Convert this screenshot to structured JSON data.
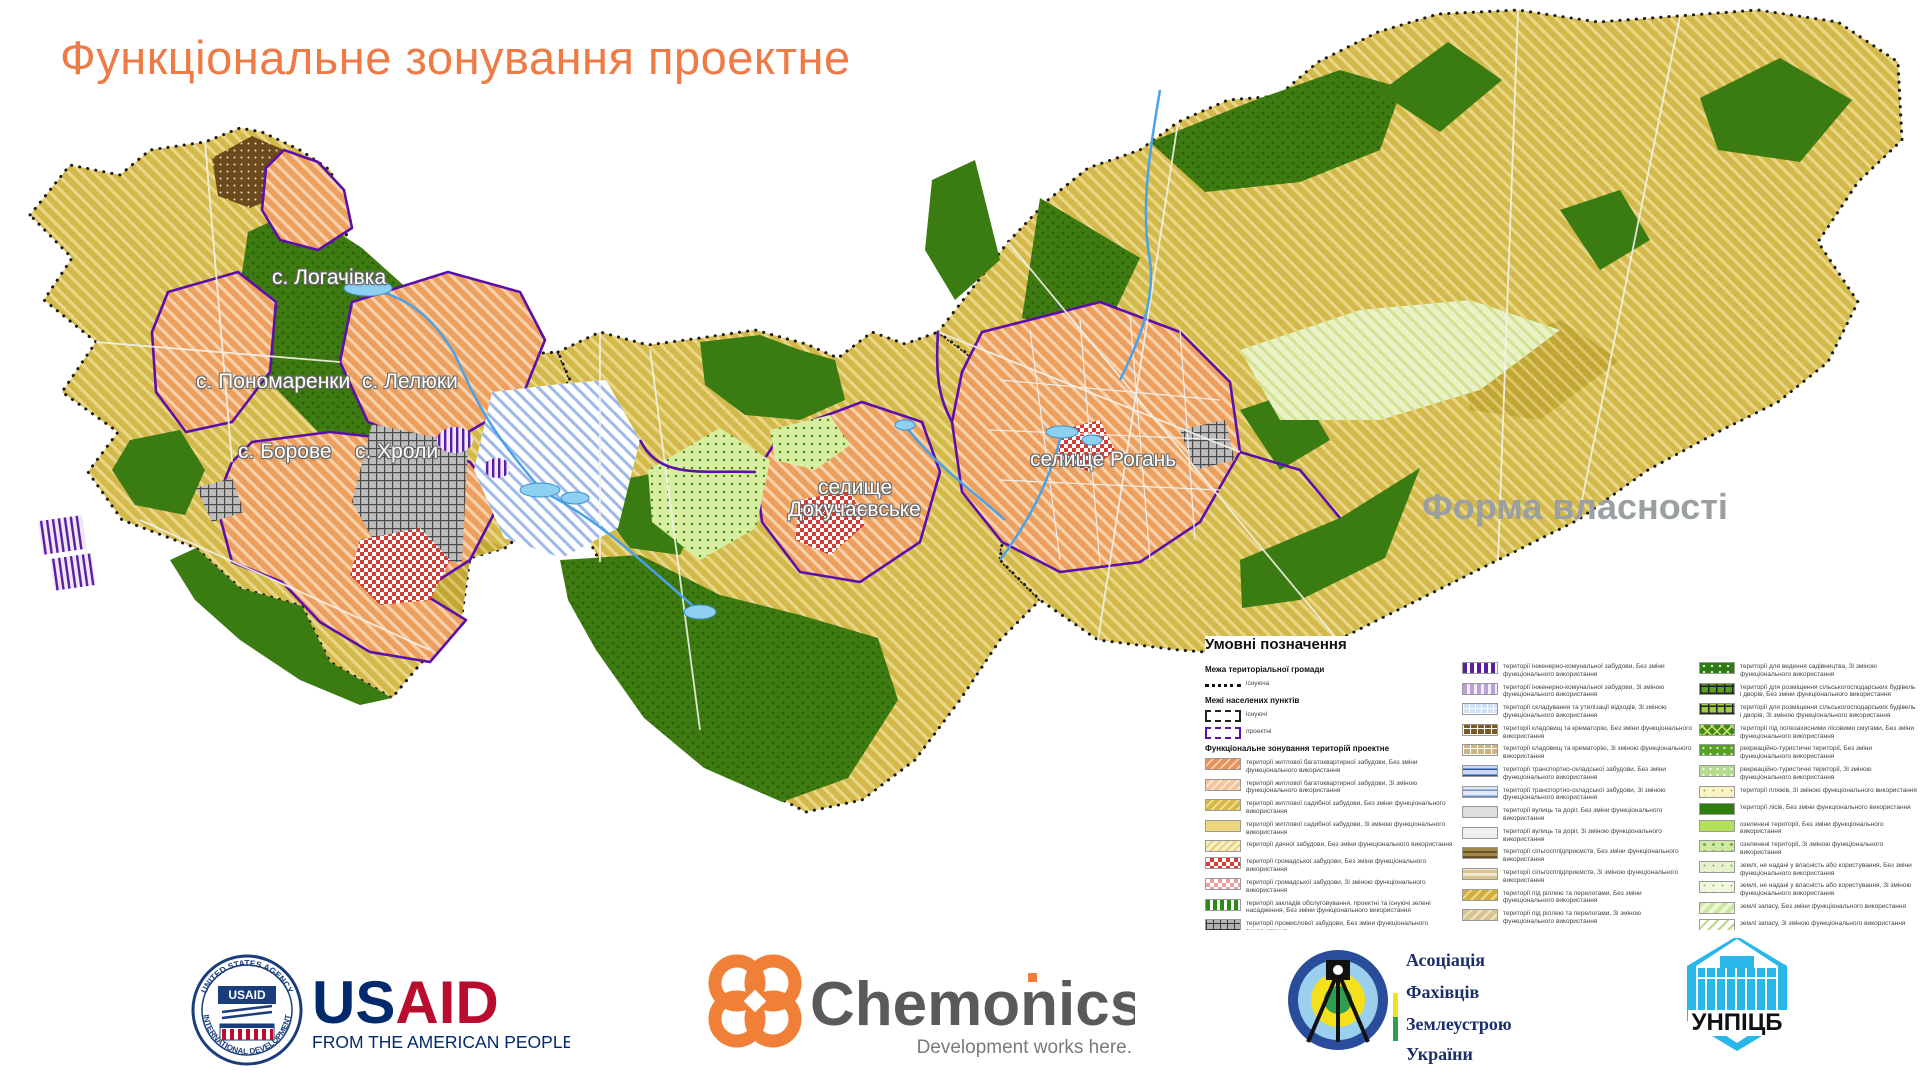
{
  "title": "Функціональне зонування проектне",
  "accent_colors": {
    "title_orange": "#ee7b45",
    "boundary_purple": "#5c10aa",
    "field_yellow": "#d3b84a",
    "forest_green": "#3a7c12",
    "settlement_orange": "#eda05e",
    "water_blue": "#8ed0f2"
  },
  "map": {
    "labels": [
      {
        "text": "с. Логачівка",
        "x": 272,
        "y": 266
      },
      {
        "text": "с. Пономаренки",
        "x": 196,
        "y": 370
      },
      {
        "text": "с. Лелюки",
        "x": 362,
        "y": 370
      },
      {
        "text": "с. Борове",
        "x": 238,
        "y": 440
      },
      {
        "text": "с. Хроли",
        "x": 355,
        "y": 440
      },
      {
        "text": "селище",
        "x": 818,
        "y": 476
      },
      {
        "text": "Докучаєвське",
        "x": 788,
        "y": 498
      },
      {
        "text": "селище Рогань",
        "x": 1030,
        "y": 448
      }
    ],
    "ownership_label": {
      "text": "Форма власності",
      "x": 1422,
      "y": 486
    }
  },
  "legend": {
    "title": "Умовні позначення",
    "col1": [
      {
        "header": "Межа територіальної громади"
      },
      {
        "symbol": "community-existing",
        "label": "існуюча"
      },
      {
        "header": "Межі населених пунктів"
      },
      {
        "symbol": "town-existing",
        "label": "існуючі"
      },
      {
        "symbol": "town-project",
        "label": "проектні"
      },
      {
        "header": "Функціональне зонування територій проектне"
      },
      {
        "swatch": "apt",
        "label": "території житлової багатоквартирної забудови, Без зміни функціонального використання"
      },
      {
        "swatch": "apt-ch",
        "label": "території житлової багатоквартирної забудови, Зі зміною функціонального використання"
      },
      {
        "swatch": "house",
        "label": "території житлової садибної забудови, Без зміни функціонального використання"
      },
      {
        "swatch": "house-ch",
        "label": "території житлової садибної забудови, Зі зміною функціонального використання"
      },
      {
        "swatch": "dacha",
        "label": "території дачної забудови, Без зміни функціонального використання"
      },
      {
        "swatch": "public",
        "label": "території громадської забудови, Без зміни функціонального використання"
      },
      {
        "swatch": "public-ch",
        "label": "території громадської забудови, Зі зміною функціонального використання"
      },
      {
        "swatch": "service",
        "label": "території закладів обслуговування, проектні та існуючі зелені насадження, Без зміни функціонального використання"
      },
      {
        "swatch": "industrial",
        "label": "території промислової забудови, Без зміни функціонального використання"
      },
      {
        "swatch": "industrial-ch",
        "label": "території промислової забудови, Зі зміною функціонального використання"
      }
    ],
    "col2": [
      {
        "swatch": "eng",
        "label": "території інженерно-комунальної забудови, Без зміни функціонального використання"
      },
      {
        "swatch": "eng-ch",
        "label": "території інженерно-комунальної забудови, Зі зміною функціонального використання"
      },
      {
        "swatch": "waste",
        "label": "території складування та утилізації відходів, Зі зміною функціонального використання"
      },
      {
        "swatch": "cem",
        "label": "території кладовищ та крематорію, Без зміни функціонального використання"
      },
      {
        "swatch": "cem-ch",
        "label": "території кладовищ та крематорію, Зі зміною функціонального використання"
      },
      {
        "swatch": "transport",
        "label": "території транспортно-складської забудови, Без зміни функціонального використання"
      },
      {
        "swatch": "transport-ch",
        "label": "території транспортно-складської забудови, Зі зміною функціонального використання"
      },
      {
        "swatch": "street",
        "label": "території вулиць та доріг, Без зміни функціонального використання"
      },
      {
        "swatch": "street-ch",
        "label": "території вулиць та доріг, Зі зміною функціонального використання"
      },
      {
        "swatch": "agri",
        "label": "території сільгосппідприємств, Без зміни функціонального використання"
      },
      {
        "swatch": "agri-ch",
        "label": "території сільгосппідприємств, Зі зміною функціонального використання"
      },
      {
        "swatch": "arable",
        "label": "території під ріллею та перелогами, Без зміни функціонального використання"
      },
      {
        "swatch": "arable-ch",
        "label": "території під ріллею та перелогами, Зі зміною функціонального використання"
      },
      {
        "swatch": "perennial",
        "label": "території під багаторічними насадженнями, Без зміни функціонального використання"
      },
      {
        "swatch": "pasture",
        "label": "території під сіножатями та пасовищами, Без зміни функціонального використання"
      }
    ],
    "col3": [
      {
        "swatch": "garden",
        "label": "території для ведення садівництва, Зі зміною функціонального використання"
      },
      {
        "swatch": "farmbld",
        "label": "території для розміщення сільськогосподарських будівель і дворів, Без зміни функціонального використання"
      },
      {
        "swatch": "farmbld-ch",
        "label": "території для розміщення сільськогосподарських будівель і дворів, Зі зміною функціонального використання"
      },
      {
        "swatch": "shelter",
        "label": "території під полезахисними лісовими смугами, Без зміни функціонального використання"
      },
      {
        "swatch": "rec",
        "label": "рекреаційно-туристичні території, Без зміни функціонального використання"
      },
      {
        "swatch": "rec-ch",
        "label": "рекреаційно-туристичні території, Зі зміною функціонального використання"
      },
      {
        "swatch": "beach",
        "label": "території пляжів, Зі зміною функціонального використання"
      },
      {
        "swatch": "forest",
        "label": "території лісів, Без зміни функціонального використання"
      },
      {
        "swatch": "green",
        "label": "озеленені території, Без зміни функціонального використання"
      },
      {
        "swatch": "green-ch",
        "label": "озеленені території, Зі зміною функціонального використання"
      },
      {
        "swatch": "unalloc",
        "label": "землі, не надані у власність або користування, Без зміни функціонального використання"
      },
      {
        "swatch": "unalloc-ch",
        "label": "землі, не надані у власність або користування, Зі зміною функціонального використання"
      },
      {
        "swatch": "reserve",
        "label": "землі запасу, Без зміни функціонального використання"
      },
      {
        "swatch": "reserve-ch",
        "label": "землі запасу, Зі зміною функціонального використання"
      },
      {
        "swatch": "water",
        "label": "водні поверхні/об'єкти, Без зміни функціонального використання"
      }
    ]
  },
  "footer": {
    "usaid": {
      "seal_top": "UNITED STATES AGENCY",
      "seal_bottom": "INTERNATIONAL DEVELOPMENT",
      "seal_center": "USAID",
      "wordmark_us": "US",
      "wordmark_aid": "AID",
      "tagline": "FROM THE AMERICAN PEOPLE"
    },
    "chemonics": {
      "name": "Chemonics",
      "tagline": "Development works here."
    },
    "afzu": {
      "line1": "Асоціація",
      "line2": "Фахівців",
      "line3": "Землеустрою",
      "line4": "України"
    },
    "unpicb": {
      "name": "УНПІЦБ"
    }
  }
}
